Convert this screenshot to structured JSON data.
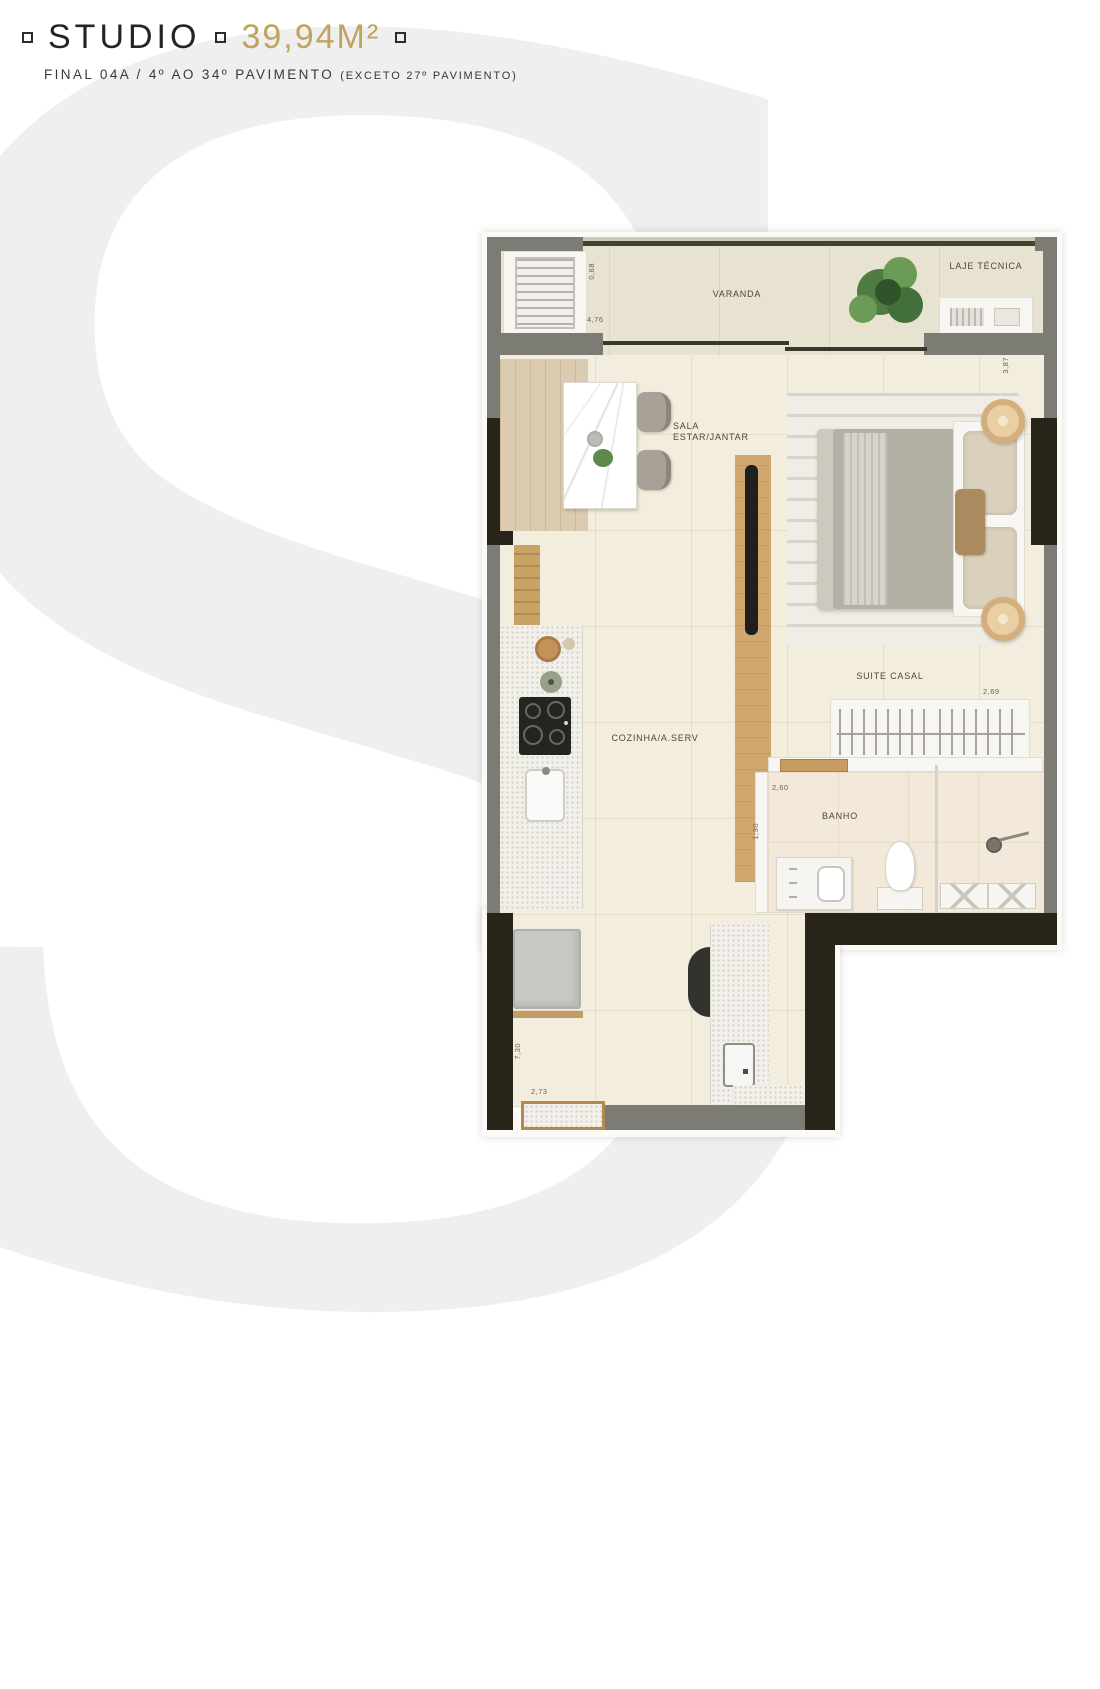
{
  "header": {
    "title": "STUDIO",
    "area": "39,94M²",
    "subtitle": "FINAL 04A / 4º AO 34º PAVIMENTO",
    "subtitle_note": "(EXCETO 27º PAVIMENTO)"
  },
  "watermark": {
    "letter": "S"
  },
  "plan": {
    "labels": {
      "varanda": "VARANDA",
      "laje_tecnica": "LAJE TÉCNICA",
      "sala": "SALA ESTAR/JANTAR",
      "cozinha": "COZINHA/A.SERV",
      "suite": "SUITE CASAL",
      "banho": "BANHO"
    },
    "dimensions": {
      "varanda_depth": "0,68",
      "varanda_width": "4,76",
      "sala_depth": "3,87",
      "suite_width": "2,69",
      "banho_width": "2,60",
      "banho_depth": "1,30",
      "leg_height": "7,30",
      "entry_width": "2,73"
    },
    "colors": {
      "accent_gold": "#c0a35e",
      "wall_gray": "#7d7c74",
      "wall_dark": "#28241b",
      "floor": "#f2ecdf",
      "wood": "#cfa76f"
    }
  }
}
